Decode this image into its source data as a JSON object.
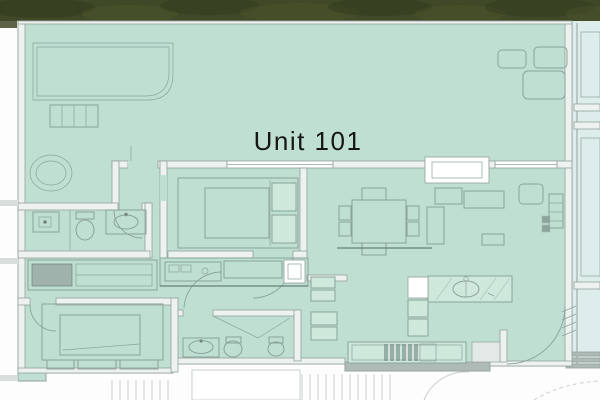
{
  "plan": {
    "unit_label": "Unit 101"
  },
  "palette": {
    "hedge": "#3f4827",
    "hedge_dark": "#2e3719",
    "hedge_light": "#5a6533",
    "unit_fill": "#bedfd2",
    "unit_fill_light": "#cfe8dc",
    "neighbor_fill": "#dcedeb",
    "outside": "#fcfdfc",
    "wall_fill": "#edf2f0",
    "wall_stroke": "#93a09c",
    "wall_dark": "#aebab6",
    "line": "#8ba39a",
    "line_dark": "#69807a",
    "faint": "#c9d0cd",
    "text": "#161616"
  }
}
